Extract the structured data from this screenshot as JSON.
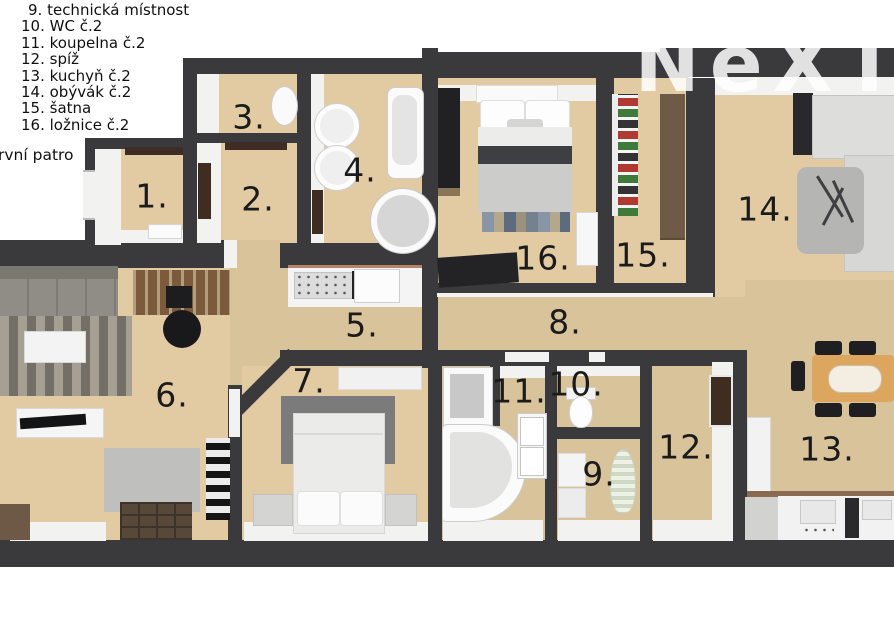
{
  "legend": {
    "items": [
      "9. technická místnost",
      "10. WC č.2",
      "11. koupelna č.2",
      "12. spíž",
      "13. kuchyň č.2",
      "14. obývák č.2",
      "15. šatna",
      "16. ložnice č.2"
    ],
    "floor_label": "rvní patro"
  },
  "watermark": {
    "text": "NeXT"
  },
  "rooms": {
    "r1": "1.",
    "r2": "2.",
    "r3": "3.",
    "r4": "4.",
    "r5": "5.",
    "r6": "6.",
    "r7": "7.",
    "r8": "8.",
    "r9": "9.",
    "r10": "10.",
    "r11": "11.",
    "r12": "12.",
    "r13": "13.",
    "r14": "14.",
    "r15": "15.",
    "r16": "16."
  },
  "colors": {
    "wall": "#3a393b",
    "floor": "#d9c39b",
    "floor_light": "#e2cba3",
    "label": "#1b1b1b",
    "wood_desk": "#7b5b3c",
    "wood_table": "#dda65e",
    "wood_wardrobe": "#6e5a47",
    "door_brown": "#3f2d22"
  }
}
